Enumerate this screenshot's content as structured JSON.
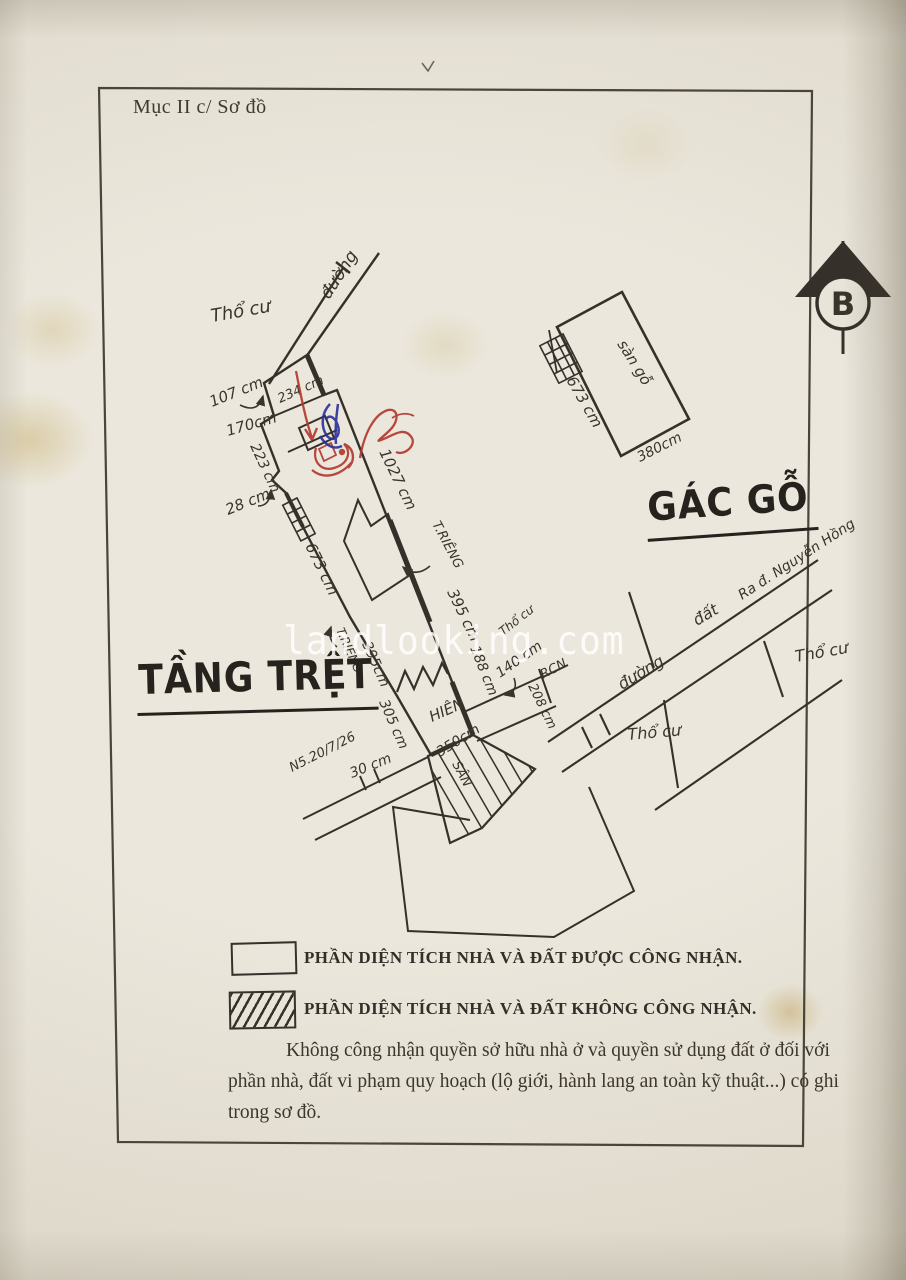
{
  "page": {
    "header": "Mục II c/ Sơ đồ",
    "watermark": "landlooking.com"
  },
  "diagram": {
    "ground_floor_title": "TẦNG TRỆT",
    "attic_title": "GÁC GỖ",
    "north_label": "B",
    "labels": {
      "tho_cu_top": "Thổ cư",
      "duong_top": "đường",
      "d107": "107 cm",
      "d234": "234 cm",
      "d170": "170cm",
      "d223": "223 cm",
      "d28": "28 cm",
      "d673_house": "673 cm",
      "d1027": "1027 cm",
      "t_rieng_1": "T.RIÊNG",
      "d395_right": "395 cm",
      "t_rieng_2": "T.RIÊNG",
      "d395_left": "395cm",
      "d188": "188 cm",
      "d140": "140 cm",
      "rcn": "RCN",
      "d208": "208 cm",
      "hien": "HIÊN",
      "d305": "305 cm",
      "d30": "30 cm",
      "d350": "350cm",
      "san": "SÂN",
      "survey_note": "N5.20/7/26",
      "duong_right": "đường",
      "dat_right": "đất",
      "ra_duong": "Ra đ. Nguyễn Hồng",
      "tho_cu_right": "Thổ cư",
      "tho_cu_mid": "Thổ cư",
      "tho_cu_small": "Thổ cư",
      "san_go": "sàn gỗ",
      "d673_attic": "673 cm",
      "d380": "380cm"
    }
  },
  "legend": {
    "recognized": "PHẦN DIỆN TÍCH NHÀ VÀ ĐẤT ĐƯỢC CÔNG NHẬN.",
    "not_recognized": "PHẦN DIỆN TÍCH NHÀ VÀ ĐẤT KHÔNG CÔNG NHẬN.",
    "note": "Không công nhận quyền sở hữu nhà ở và quyền sử dụng đất ở đối với phần nhà, đất vi phạm quy hoạch (lộ giới, hành lang an toàn kỹ thuật...) có ghi trong sơ đồ."
  },
  "colors": {
    "ink": "#35302a",
    "red_pen": "#b23a30",
    "blue_pen": "#2c2f9c",
    "paper": "#e8e4d8"
  }
}
